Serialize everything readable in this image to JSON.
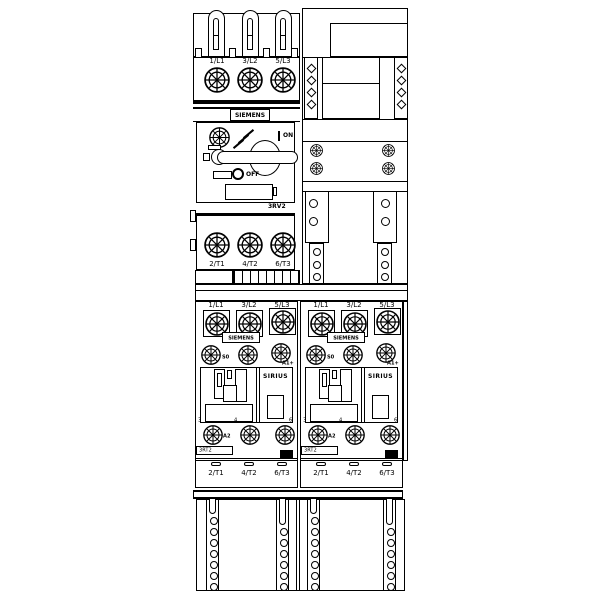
{
  "brand": "SIEMENS",
  "colors": {
    "line": "#000000",
    "background": "#ffffff"
  },
  "breaker": {
    "model": "3RV2",
    "on_label": "ON",
    "off_label": "OFF",
    "top_terminals": [
      "1/L1",
      "3/L2",
      "5/L3"
    ],
    "bottom_terminals": [
      "2/T1",
      "4/T2",
      "6/T3"
    ]
  },
  "contactors": [
    {
      "brand": "SIEMENS",
      "series": "SIRIUS",
      "model": "3RT2",
      "size_label": "S0",
      "coil_terminal_plus": "A1+",
      "coil_terminal_minus": "A2",
      "aux_marks": [
        "3",
        "4",
        "6"
      ],
      "top_terminals": [
        "1/L1",
        "3/L2",
        "5/L3"
      ],
      "bottom_terminals": [
        "2/T1",
        "4/T2",
        "6/T3"
      ]
    },
    {
      "brand": "SIEMENS",
      "series": "SIRIUS",
      "model": "3RT2",
      "size_label": "S0",
      "coil_terminal_plus": "A1+",
      "coil_terminal_minus": "A2",
      "aux_marks": [
        "3",
        "4",
        "6"
      ],
      "top_terminals": [
        "1/L1",
        "3/L2",
        "5/L3"
      ],
      "bottom_terminals": [
        "2/T1",
        "4/T2",
        "6/T3"
      ]
    }
  ]
}
